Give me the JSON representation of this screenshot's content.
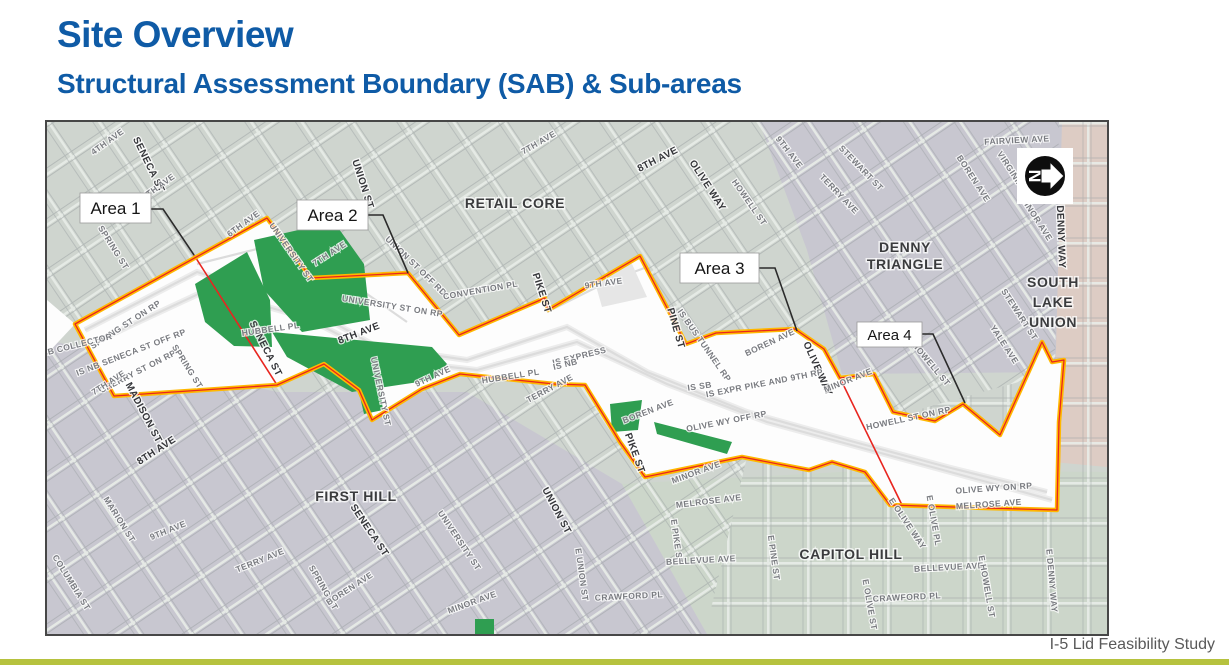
{
  "slide": {
    "title": "Site Overview",
    "subtitle": "Structural Assessment Boundary (SAB) & Sub-areas",
    "footer": "I-5 Lid Feasibility Study"
  },
  "colors": {
    "title_blue": "#0f5ba6",
    "accent_bar_green": "#b6c23e",
    "boundary_yellow": "#ffb800",
    "boundary_red": "#e8251f",
    "lid_green": "#2f9e51",
    "district_sage": "#cfd5cf",
    "district_gray": "#c8c7d0",
    "district_capitol_sage": "#ccd6ca",
    "district_pink": "#ddccc4"
  },
  "map": {
    "north_arrow_letter": "N",
    "areas": [
      {
        "label": "Area 1"
      },
      {
        "label": "Area 2"
      },
      {
        "label": "Area 3"
      },
      {
        "label": "Area 4"
      }
    ],
    "districts": [
      {
        "lines": [
          "RETAIL CORE"
        ],
        "x": 468,
        "y": 86,
        "dy": 17
      },
      {
        "lines": [
          "DENNY",
          "TRIANGLE"
        ],
        "x": 858,
        "y": 130,
        "dy": 17
      },
      {
        "lines": [
          "SOUTH",
          "LAKE",
          "UNION"
        ],
        "x": 1006,
        "y": 165,
        "dy": 20
      },
      {
        "lines": [
          "FIRST HILL"
        ],
        "x": 309,
        "y": 379,
        "dy": 17
      },
      {
        "lines": [
          "CAPITOL HILL"
        ],
        "x": 804,
        "y": 437,
        "dy": 17
      }
    ],
    "streets": [
      {
        "label": "4TH AVE",
        "x": 62,
        "y": 22,
        "a": -36,
        "s": "m"
      },
      {
        "label": "SENECA ST",
        "x": 99,
        "y": 44,
        "a": 64,
        "s": "b"
      },
      {
        "label": "5TH AVE",
        "x": 113,
        "y": 67,
        "a": -36,
        "s": "m"
      },
      {
        "label": "UNION ST",
        "x": 313,
        "y": 63,
        "a": 72,
        "s": "b"
      },
      {
        "label": "6TH AVE",
        "x": 198,
        "y": 104,
        "a": -36,
        "s": "m"
      },
      {
        "label": "UNIVERSITY ST",
        "x": 242,
        "y": 132,
        "a": 55,
        "s": "m"
      },
      {
        "label": "SPRING ST",
        "x": 64,
        "y": 127,
        "a": 58,
        "s": "m"
      },
      {
        "label": "7TH AVE",
        "x": 284,
        "y": 134,
        "a": -33,
        "s": "m"
      },
      {
        "label": "UNION ST OFF RD",
        "x": 367,
        "y": 146,
        "a": 44,
        "s": "m"
      },
      {
        "label": "UNIVERSITY ST ON RP",
        "x": 345,
        "y": 187,
        "a": 9,
        "s": "m"
      },
      {
        "label": "7TH AVE",
        "x": 493,
        "y": 23,
        "a": -30,
        "s": "m"
      },
      {
        "label": "8TH AVE",
        "x": 612,
        "y": 40,
        "a": -27,
        "s": "b"
      },
      {
        "label": "OLIVE WAY",
        "x": 658,
        "y": 65,
        "a": 57,
        "s": "b"
      },
      {
        "label": "9TH AVE",
        "x": 740,
        "y": 32,
        "a": 52,
        "s": "m"
      },
      {
        "label": "HOWELL ST",
        "x": 700,
        "y": 82,
        "a": 55,
        "s": "m"
      },
      {
        "label": "FAIRVIEW AVE",
        "x": 970,
        "y": 21,
        "a": -3,
        "s": "m"
      },
      {
        "label": "STEWART ST",
        "x": 812,
        "y": 48,
        "a": 46,
        "s": "m"
      },
      {
        "label": "TERRY AVE",
        "x": 790,
        "y": 74,
        "a": 46,
        "s": "m"
      },
      {
        "label": "BOREN AVE",
        "x": 924,
        "y": 58,
        "a": 57,
        "s": "m"
      },
      {
        "label": "VIRGINIA ST",
        "x": 965,
        "y": 55,
        "a": 57,
        "s": "m"
      },
      {
        "label": "MINOR AVE",
        "x": 987,
        "y": 98,
        "a": 57,
        "s": "m"
      },
      {
        "label": "DENNY WAY",
        "x": 1011,
        "y": 115,
        "a": 88,
        "s": "b"
      },
      {
        "label": "CONVENTION PL",
        "x": 434,
        "y": 171,
        "a": -10,
        "s": "m"
      },
      {
        "label": "PIKE ST",
        "x": 492,
        "y": 172,
        "a": 72,
        "s": "b"
      },
      {
        "label": "9TH AVE",
        "x": 557,
        "y": 164,
        "a": -8,
        "s": "m"
      },
      {
        "label": "PINE ST",
        "x": 626,
        "y": 207,
        "a": 74,
        "s": "b"
      },
      {
        "label": "IS BUS TUNNEL RP",
        "x": 655,
        "y": 225,
        "a": 55,
        "s": "m"
      },
      {
        "label": "BOREN AVE",
        "x": 724,
        "y": 223,
        "a": -25,
        "s": "m"
      },
      {
        "label": "OLIVE WAY",
        "x": 768,
        "y": 248,
        "a": 66,
        "s": "b"
      },
      {
        "label": "IS EXPRESS",
        "x": 533,
        "y": 237,
        "a": -14,
        "s": "m"
      },
      {
        "label": "IS NB",
        "x": 519,
        "y": 245,
        "a": -14,
        "s": "m"
      },
      {
        "label": "SPRING ST ON RP",
        "x": 80,
        "y": 205,
        "a": -33,
        "s": "m"
      },
      {
        "label": "IS SB COLLECTOR",
        "x": 25,
        "y": 227,
        "a": -14,
        "s": "m"
      },
      {
        "label": "IS NB SENECA ST OFF RP",
        "x": 85,
        "y": 233,
        "a": -21,
        "s": "m"
      },
      {
        "label": "CHERRY ST ON RP",
        "x": 92,
        "y": 252,
        "a": -27,
        "s": "m"
      },
      {
        "label": "7TH AVE",
        "x": 63,
        "y": 263,
        "a": -33,
        "s": "m"
      },
      {
        "label": "SPRING ST",
        "x": 138,
        "y": 246,
        "a": 58,
        "s": "m"
      },
      {
        "label": "SENECA ST",
        "x": 216,
        "y": 228,
        "a": 63,
        "s": "b"
      },
      {
        "label": "HUBBELL PL",
        "x": 224,
        "y": 210,
        "a": -8,
        "s": "m"
      },
      {
        "label": "MADISON ST",
        "x": 94,
        "y": 292,
        "a": 62,
        "s": "b"
      },
      {
        "label": "8TH AVE",
        "x": 111,
        "y": 331,
        "a": -33,
        "s": "b"
      },
      {
        "label": "8TH AVE",
        "x": 313,
        "y": 214,
        "a": -21,
        "s": "b"
      },
      {
        "label": "9TH AVE",
        "x": 387,
        "y": 257,
        "a": -25,
        "s": "m"
      },
      {
        "label": "UNIVERSITY ST",
        "x": 331,
        "y": 270,
        "a": 78,
        "s": "m"
      },
      {
        "label": "HUBBELL PL",
        "x": 464,
        "y": 257,
        "a": -9,
        "s": "m"
      },
      {
        "label": "TERRY AVE",
        "x": 504,
        "y": 269,
        "a": -28,
        "s": "m"
      },
      {
        "label": "IS SB",
        "x": 653,
        "y": 267,
        "a": -8,
        "s": "m"
      },
      {
        "label": "IS EXPR PIKE AND 9TH RP",
        "x": 718,
        "y": 264,
        "a": -11,
        "s": "m"
      },
      {
        "label": "OLIVE WY OFF RP",
        "x": 680,
        "y": 302,
        "a": -11,
        "s": "m"
      },
      {
        "label": "BOREN AVE",
        "x": 602,
        "y": 292,
        "a": -21,
        "s": "m"
      },
      {
        "label": "PIKE ST",
        "x": 585,
        "y": 332,
        "a": 70,
        "s": "b"
      },
      {
        "label": "MINOR AVE",
        "x": 650,
        "y": 353,
        "a": -20,
        "s": "m"
      },
      {
        "label": "MELROSE AVE",
        "x": 662,
        "y": 382,
        "a": -7,
        "s": "m"
      },
      {
        "label": "HOWELL ST",
        "x": 882,
        "y": 244,
        "a": 50,
        "s": "m"
      },
      {
        "label": "MINOR AVE",
        "x": 802,
        "y": 261,
        "a": -22,
        "s": "m"
      },
      {
        "label": "HOWELL ST ON RP",
        "x": 862,
        "y": 299,
        "a": -12,
        "s": "m"
      },
      {
        "label": "STEWART ST",
        "x": 970,
        "y": 194,
        "a": 57,
        "s": "m"
      },
      {
        "label": "YALE AVE",
        "x": 955,
        "y": 224,
        "a": 57,
        "s": "m"
      },
      {
        "label": "OLIVE WY ON RP",
        "x": 947,
        "y": 369,
        "a": -4,
        "s": "m"
      },
      {
        "label": "MELROSE AVE",
        "x": 942,
        "y": 385,
        "a": -4,
        "s": "m"
      },
      {
        "label": "MARION ST",
        "x": 70,
        "y": 399,
        "a": 58,
        "s": "m"
      },
      {
        "label": "9TH AVE",
        "x": 122,
        "y": 411,
        "a": -22,
        "s": "m"
      },
      {
        "label": "COLUMBIA ST",
        "x": 22,
        "y": 462,
        "a": 58,
        "s": "m"
      },
      {
        "label": "TERRY AVE",
        "x": 214,
        "y": 441,
        "a": -22,
        "s": "m"
      },
      {
        "label": "SPRING ST",
        "x": 274,
        "y": 467,
        "a": 60,
        "s": "m"
      },
      {
        "label": "SENECA ST",
        "x": 320,
        "y": 410,
        "a": 56,
        "s": "b"
      },
      {
        "label": "BOREN AVE",
        "x": 304,
        "y": 469,
        "a": -33,
        "s": "m"
      },
      {
        "label": "UNION ST",
        "x": 507,
        "y": 390,
        "a": 62,
        "s": "b"
      },
      {
        "label": "UNIVERSITY ST",
        "x": 410,
        "y": 420,
        "a": 56,
        "s": "m"
      },
      {
        "label": "MINOR AVE",
        "x": 426,
        "y": 483,
        "a": -20,
        "s": "m"
      },
      {
        "label": "E UNION ST",
        "x": 532,
        "y": 453,
        "a": 82,
        "s": "m"
      },
      {
        "label": "CRAWFORD PL",
        "x": 582,
        "y": 477,
        "a": -3,
        "s": "m"
      },
      {
        "label": "E PIKE ST",
        "x": 627,
        "y": 420,
        "a": 82,
        "s": "m"
      },
      {
        "label": "BELLEVUE AVE",
        "x": 654,
        "y": 441,
        "a": -3,
        "s": "m"
      },
      {
        "label": "E PINE ST",
        "x": 724,
        "y": 436,
        "a": 82,
        "s": "m"
      },
      {
        "label": "E OLIVE WAY",
        "x": 858,
        "y": 403,
        "a": 56,
        "s": "m"
      },
      {
        "label": "E OLIVE PL",
        "x": 884,
        "y": 399,
        "a": 80,
        "s": "m"
      },
      {
        "label": "BELLEVUE AVE",
        "x": 902,
        "y": 448,
        "a": -3,
        "s": "m"
      },
      {
        "label": "E OLIVE ST",
        "x": 820,
        "y": 483,
        "a": 80,
        "s": "m"
      },
      {
        "label": "CRAWFORD PL",
        "x": 860,
        "y": 478,
        "a": -3,
        "s": "m"
      },
      {
        "label": "E HOWELL ST",
        "x": 937,
        "y": 465,
        "a": 80,
        "s": "m"
      },
      {
        "label": "E DENNY WAY",
        "x": 1002,
        "y": 459,
        "a": 85,
        "s": "m"
      }
    ]
  }
}
